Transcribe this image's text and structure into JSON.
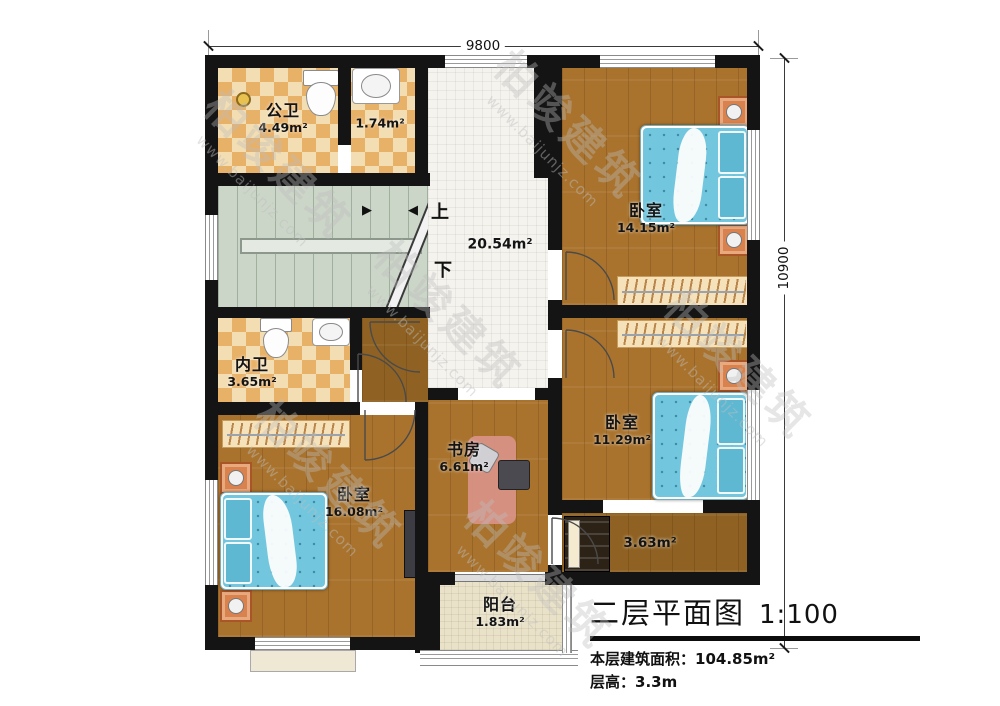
{
  "watermark": {
    "brand": "柏竣建筑",
    "url": "www.baijunjz.com"
  },
  "dimensions": {
    "width": "9800",
    "height": "10900"
  },
  "stairs": {
    "up": "上",
    "down": "下"
  },
  "rooms": {
    "public_bath": {
      "name": "公卫",
      "area": "4.49m²"
    },
    "bath_small": {
      "area": "1.74m²"
    },
    "hallway": {
      "area": "20.54m²"
    },
    "bedroom_ne": {
      "name": "卧室",
      "area": "14.15m²"
    },
    "inner_bath": {
      "name": "内卫",
      "area": "3.65m²"
    },
    "bedroom_e": {
      "name": "卧室",
      "area": "11.29m²"
    },
    "study": {
      "name": "书房",
      "area": "6.61m²"
    },
    "bedroom_sw": {
      "name": "卧室",
      "area": "16.08m²"
    },
    "corridor": {
      "area": "3.63m²"
    },
    "balcony": {
      "name": "阳台",
      "area": "1.83m²"
    }
  },
  "title_block": {
    "title": "二层平面图",
    "scale": "1:100",
    "floor_area_label": "本层建筑面积：",
    "floor_area_value": "104.85m²",
    "floor_height_label": "层高：",
    "floor_height_value": "3.3m"
  },
  "colors": {
    "wall": "#141414",
    "wood": "#a9732e",
    "tile_light": "#f3ddb2",
    "tile_dark": "#e8b168",
    "stair": "#ccd6c8",
    "hall_tile": "#f4f3ee",
    "balcony_tile": "#eae2c8",
    "bed": "#72c6de",
    "nightstand": "#d9824d"
  }
}
